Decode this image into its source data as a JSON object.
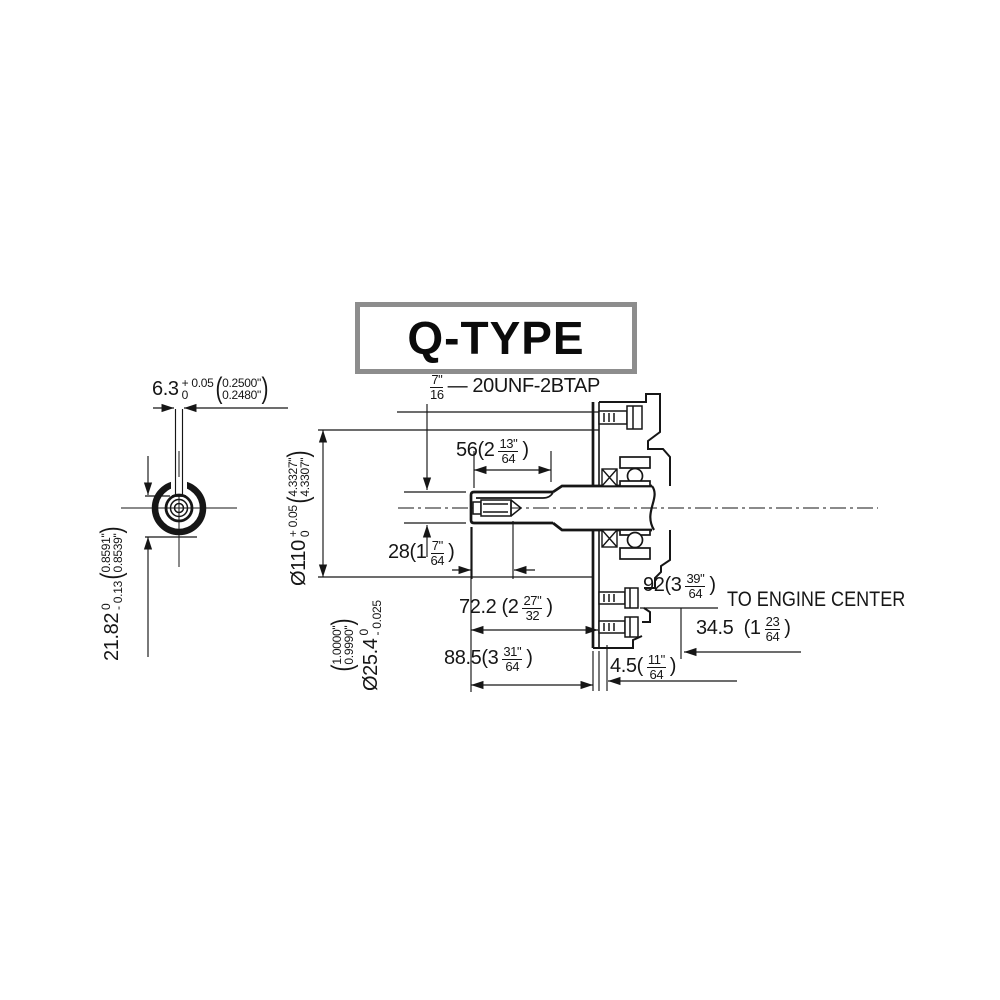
{
  "title": "Q-TYPE",
  "glyphs": {
    "open": "(",
    "close": ")"
  },
  "callouts": {
    "thread_tap": {
      "num": "7\"",
      "den": "16",
      "rest": "— 20UNF-2BTAP"
    },
    "engine_center": "TO ENGINE CENTER"
  },
  "dims": {
    "keyway_width": {
      "value": "6.3",
      "tol_up": "+ 0.05",
      "tol_dn": "0",
      "in_up": "0.2500\"",
      "in_dn": "0.2480\""
    },
    "key_cut": {
      "value": "21.82",
      "tol_up": "0",
      "tol_dn": "- 0.13",
      "in_up": "0.8591\"",
      "in_dn": "0.8539\""
    },
    "pilot_dia": {
      "value": "Ø110",
      "tol_up": "+ 0.05",
      "tol_dn": "0",
      "in_up": "4.3327\"",
      "in_dn": "4.3307\""
    },
    "shaft_dia": {
      "value": "Ø25.4",
      "tol_up": "0",
      "tol_dn": "- 0.025",
      "in_up": "1.0000\"",
      "in_dn": "0.9990\""
    },
    "keyway_len": {
      "pre": "56(2",
      "num": "13\"",
      "den": "64",
      "post": ")"
    },
    "thread_depth": {
      "pre": "28(1",
      "num": "7\"",
      "den": "64",
      "post": ")"
    },
    "shoulder_len": {
      "pre": "72.2 (2",
      "num": "27\"",
      "den": "32",
      "post": ")"
    },
    "shaft_len": {
      "pre": "88.5(3",
      "num": "31\"",
      "den": "64",
      "post": ")"
    },
    "face_offset": {
      "pre": "4.5(",
      "num": "11\"",
      "den": "64",
      "post": ")"
    },
    "to_engine_center": {
      "pre": "92(3",
      "num": "39\"",
      "den": "64",
      "post": ")"
    },
    "center_offset": {
      "pre": "34.5  (1",
      "num": "23",
      "den": "64",
      "post": ")"
    }
  }
}
